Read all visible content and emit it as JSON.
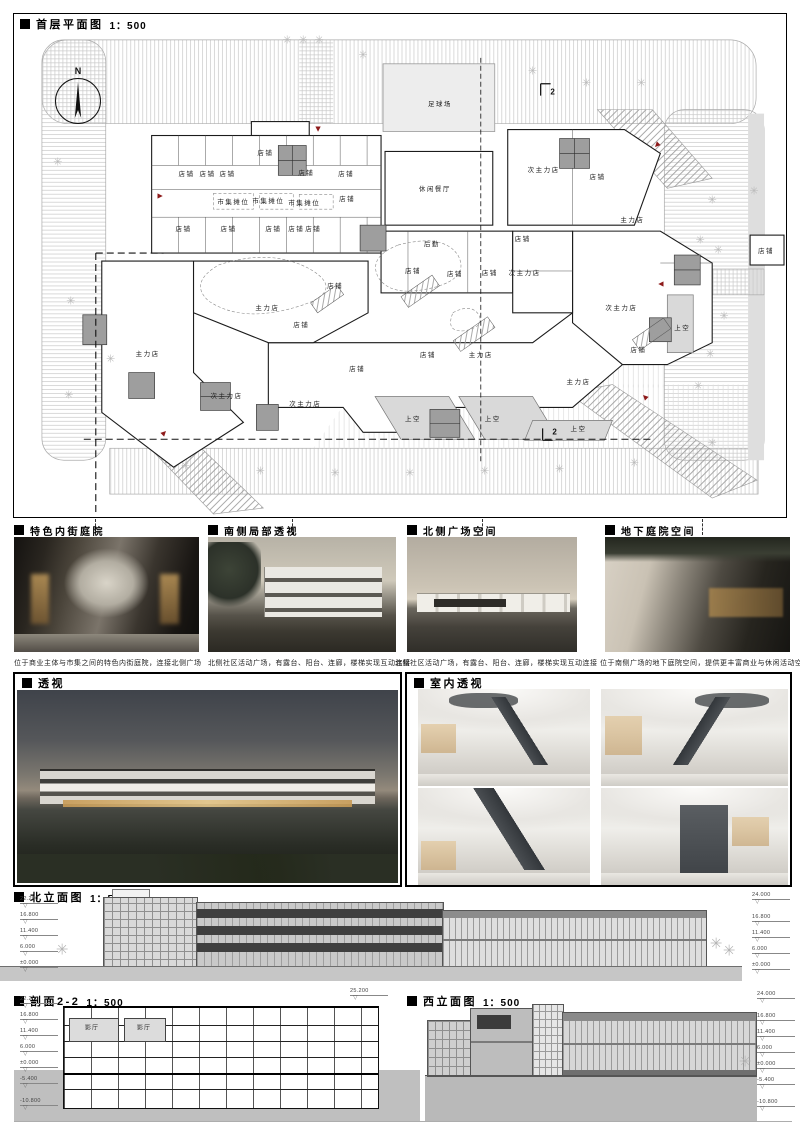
{
  "plan": {
    "title": "首层平面图",
    "scale": "1：500",
    "north": "N",
    "section_marker": "2",
    "entry_color": "#8e1b1b",
    "labels": [
      {
        "t": "足球场",
        "x": 427,
        "y": 89
      },
      {
        "t": "休闲餐厅",
        "x": 422,
        "y": 175
      },
      {
        "t": "后勤",
        "x": 419,
        "y": 230
      },
      {
        "t": "市集摊位",
        "x": 220,
        "y": 188
      },
      {
        "t": "市集摊位",
        "x": 255,
        "y": 187
      },
      {
        "t": "市集摊位",
        "x": 291,
        "y": 189
      },
      {
        "t": "主力店",
        "x": 620,
        "y": 206
      },
      {
        "t": "主力店",
        "x": 254,
        "y": 294
      },
      {
        "t": "主力店",
        "x": 134,
        "y": 340
      },
      {
        "t": "主力店",
        "x": 468,
        "y": 341
      },
      {
        "t": "主力店",
        "x": 566,
        "y": 368
      },
      {
        "t": "次主力店",
        "x": 531,
        "y": 156
      },
      {
        "t": "次主力店",
        "x": 512,
        "y": 259
      },
      {
        "t": "次主力店",
        "x": 213,
        "y": 383
      },
      {
        "t": "次主力店",
        "x": 292,
        "y": 391
      },
      {
        "t": "次主力店",
        "x": 609,
        "y": 294
      },
      {
        "t": "上空",
        "x": 400,
        "y": 406
      },
      {
        "t": "上空",
        "x": 480,
        "y": 406
      },
      {
        "t": "上空",
        "x": 566,
        "y": 416
      },
      {
        "t": "上空",
        "x": 670,
        "y": 314
      },
      {
        "t": "店铺",
        "x": 252,
        "y": 139
      },
      {
        "t": "店铺",
        "x": 173,
        "y": 160
      },
      {
        "t": "店铺",
        "x": 194,
        "y": 160
      },
      {
        "t": "店铺",
        "x": 214,
        "y": 160
      },
      {
        "t": "店铺",
        "x": 293,
        "y": 159
      },
      {
        "t": "店铺",
        "x": 333,
        "y": 160
      },
      {
        "t": "店铺",
        "x": 585,
        "y": 163
      },
      {
        "t": "店铺",
        "x": 334,
        "y": 185
      },
      {
        "t": "店铺",
        "x": 170,
        "y": 215
      },
      {
        "t": "店铺",
        "x": 215,
        "y": 215
      },
      {
        "t": "店铺",
        "x": 260,
        "y": 215
      },
      {
        "t": "店铺",
        "x": 283,
        "y": 215
      },
      {
        "t": "店铺",
        "x": 300,
        "y": 215
      },
      {
        "t": "店铺",
        "x": 510,
        "y": 225
      },
      {
        "t": "店铺",
        "x": 400,
        "y": 257
      },
      {
        "t": "店铺",
        "x": 442,
        "y": 260
      },
      {
        "t": "店铺",
        "x": 477,
        "y": 259
      },
      {
        "t": "店铺",
        "x": 322,
        "y": 272
      },
      {
        "t": "店铺",
        "x": 288,
        "y": 311
      },
      {
        "t": "店铺",
        "x": 344,
        "y": 355
      },
      {
        "t": "店铺",
        "x": 415,
        "y": 341
      },
      {
        "t": "店铺",
        "x": 626,
        "y": 336
      },
      {
        "t": "店铺",
        "x": 754,
        "y": 237
      }
    ],
    "markers": [
      {
        "t": "2",
        "x": 540,
        "y": 78
      },
      {
        "t": "2",
        "x": 542,
        "y": 420
      }
    ],
    "trees": [
      [
        274,
        27
      ],
      [
        290,
        27
      ],
      [
        306,
        27
      ],
      [
        350,
        42
      ],
      [
        520,
        58
      ],
      [
        574,
        70
      ],
      [
        629,
        70
      ],
      [
        700,
        188
      ],
      [
        742,
        179
      ],
      [
        706,
        238
      ],
      [
        688,
        228
      ],
      [
        712,
        304
      ],
      [
        698,
        342
      ],
      [
        686,
        374
      ],
      [
        57,
        289
      ],
      [
        97,
        347
      ],
      [
        55,
        384
      ],
      [
        44,
        150
      ],
      [
        172,
        455
      ],
      [
        247,
        460
      ],
      [
        322,
        462
      ],
      [
        397,
        462
      ],
      [
        472,
        460
      ],
      [
        547,
        458
      ],
      [
        622,
        452
      ],
      [
        700,
        432
      ]
    ],
    "triangles": [
      {
        "x": 305,
        "y": 115,
        "r": 180
      },
      {
        "x": 645,
        "y": 132,
        "r": 225
      },
      {
        "x": 146,
        "y": 183,
        "r": 90
      },
      {
        "x": 150,
        "y": 421,
        "r": 45
      },
      {
        "x": 649,
        "y": 271,
        "r": 270
      },
      {
        "x": 633,
        "y": 385,
        "r": 315
      }
    ]
  },
  "photo_row": [
    {
      "title": "特色内街庭院",
      "caption": "位于商业主体与市集之间的特色内街庭院，连接北侧广场"
    },
    {
      "title": "南侧局部透视",
      "caption": "北侧社区活动广场，有露台、阳台、连廊，楼梯实现互动连接"
    },
    {
      "title": "北侧广场空间",
      "caption": "北侧社区活动广场，有露台、阳台、连廊，楼梯实现互动连接"
    },
    {
      "title": "地下庭院空间",
      "caption": "位于南侧广场的地下庭院空间，提供更丰富商业与休闲活动空间"
    }
  ],
  "perspective": {
    "title": "透视"
  },
  "interior": {
    "title": "室内透视"
  },
  "north_elev": {
    "title": "北立面图",
    "scale": "1：500",
    "levels_left": [
      "22.200",
      "16.800",
      "11.400",
      "6.000",
      "±0.000"
    ],
    "levels_right": [
      "24.000",
      "16.800",
      "11.400",
      "6.000",
      "±0.000"
    ]
  },
  "section22": {
    "title": "剖面2-2",
    "scale": "1：500",
    "top_level": "25.200",
    "levels_left": [
      "22.200",
      "16.800",
      "11.400",
      "6.000",
      "±0.000",
      "-5.400",
      "-10.800"
    ],
    "rooms": [
      "影厅",
      "影厅"
    ]
  },
  "west_elev": {
    "title": "西立面图",
    "scale": "1：500",
    "levels_right": [
      "24.000",
      "16.800",
      "11.400",
      "6.000",
      "±0.000",
      "-5.400",
      "-10.800"
    ]
  }
}
